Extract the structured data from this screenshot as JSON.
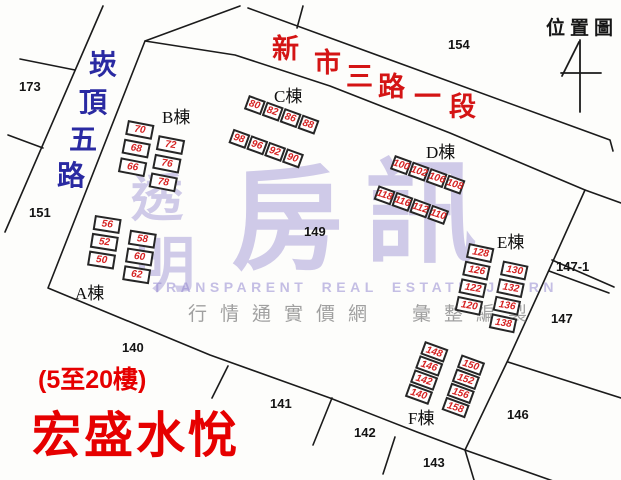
{
  "legend": {
    "title": "位置圖"
  },
  "project": {
    "floors_note": "(5至20樓)",
    "name": "宏盛水悅"
  },
  "watermark": {
    "small_chars": [
      {
        "ch": "透",
        "x": 131,
        "y": 173,
        "size": 52
      },
      {
        "ch": "明",
        "x": 135,
        "y": 236,
        "size": 60
      }
    ],
    "large_chars": [
      {
        "ch": "房",
        "x": 231,
        "y": 165,
        "size": 112
      },
      {
        "ch": "訊",
        "x": 365,
        "y": 158,
        "size": 112
      }
    ],
    "english": "TRANSPARENT REAL ESTATE JOURN",
    "attribution": "行情通實價網　彙整編製"
  },
  "streets": [
    {
      "name": "崁頂五路",
      "color": "#2a2aa2",
      "size": 28,
      "chars": [
        {
          "ch": "崁",
          "x": 89,
          "y": 51
        },
        {
          "ch": "頂",
          "x": 79,
          "y": 89
        },
        {
          "ch": "五",
          "x": 69,
          "y": 126
        },
        {
          "ch": "路",
          "x": 57,
          "y": 162
        }
      ]
    },
    {
      "name": "新市三路一段",
      "color": "#d41414",
      "size": 27,
      "chars": [
        {
          "ch": "新",
          "x": 272,
          "y": 36
        },
        {
          "ch": "市",
          "x": 314,
          "y": 50
        },
        {
          "ch": "三",
          "x": 346,
          "y": 64
        },
        {
          "ch": "路",
          "x": 378,
          "y": 74
        },
        {
          "ch": "一",
          "x": 414,
          "y": 84
        },
        {
          "ch": "段",
          "x": 449,
          "y": 94
        }
      ]
    }
  ],
  "lots": [
    {
      "label": "173",
      "x": 19,
      "y": 79
    },
    {
      "label": "151",
      "x": 29,
      "y": 205
    },
    {
      "label": "154",
      "x": 448,
      "y": 37
    },
    {
      "label": "149",
      "x": 304,
      "y": 224
    },
    {
      "label": "147-1",
      "x": 556,
      "y": 259
    },
    {
      "label": "147",
      "x": 551,
      "y": 311
    },
    {
      "label": "146",
      "x": 507,
      "y": 407
    },
    {
      "label": "140",
      "x": 122,
      "y": 340
    },
    {
      "label": "141",
      "x": 270,
      "y": 396
    },
    {
      "label": "142",
      "x": 354,
      "y": 425
    },
    {
      "label": "143",
      "x": 423,
      "y": 455
    }
  ],
  "buildings": [
    {
      "id": "A",
      "name": "A棟",
      "label": {
        "x": 75,
        "y": 279
      },
      "origin": {
        "x": 95,
        "y": 215
      },
      "rotation": 9,
      "orientation": "v",
      "cell": {
        "w": 27,
        "h": 15,
        "gap": 3
      },
      "groups": [
        {
          "dx": 0,
          "dy": 0,
          "units": [
            "56",
            "52",
            "50"
          ]
        },
        {
          "dx": 37,
          "dy": 9,
          "units": [
            "58",
            "60",
            "62"
          ]
        }
      ]
    },
    {
      "id": "B",
      "name": "B棟",
      "label": {
        "x": 162,
        "y": 103
      },
      "origin": {
        "x": 128,
        "y": 120
      },
      "rotation": 11,
      "orientation": "v",
      "cell": {
        "w": 27,
        "h": 15,
        "gap": 4
      },
      "groups": [
        {
          "dx": 0,
          "dy": 0,
          "units": [
            "70",
            "68",
            "66"
          ]
        },
        {
          "dx": 33,
          "dy": 9,
          "units": [
            "72",
            "76",
            "78"
          ]
        }
      ]
    },
    {
      "id": "C",
      "name": "C棟",
      "label": {
        "x": 274,
        "y": 82
      },
      "origin": {
        "x": 249,
        "y": 95
      },
      "rotation": 20,
      "orientation": "h",
      "cell": {
        "w": 18,
        "h": 15,
        "gap": 1
      },
      "groups": [
        {
          "dx": 0,
          "dy": 0,
          "units": [
            "80",
            "82",
            "86",
            "88"
          ]
        },
        {
          "dx": -3,
          "dy": 37,
          "units": [
            "98",
            "96",
            "92",
            "90"
          ]
        }
      ]
    },
    {
      "id": "D",
      "name": "D棟",
      "label": {
        "x": 426,
        "y": 138
      },
      "origin": {
        "x": 395,
        "y": 155
      },
      "rotation": 20,
      "orientation": "h",
      "cell": {
        "w": 18,
        "h": 15,
        "gap": 1
      },
      "groups": [
        {
          "dx": 0,
          "dy": 0,
          "units": [
            "100",
            "102",
            "106",
            "108"
          ]
        },
        {
          "dx": -5,
          "dy": 34,
          "units": [
            "118",
            "116",
            "112",
            "110"
          ]
        }
      ]
    },
    {
      "id": "E",
      "name": "E棟",
      "label": {
        "x": 497,
        "y": 228
      },
      "origin": {
        "x": 469,
        "y": 243
      },
      "rotation": 12,
      "orientation": "v",
      "cell": {
        "w": 26,
        "h": 15,
        "gap": 3
      },
      "groups": [
        {
          "dx": 0,
          "dy": 0,
          "units": [
            "128",
            "126",
            "122",
            "120"
          ]
        },
        {
          "dx": 37,
          "dy": 10,
          "units": [
            "130",
            "132",
            "136",
            "138"
          ]
        }
      ]
    },
    {
      "id": "F",
      "name": "F棟",
      "label": {
        "x": 408,
        "y": 404
      },
      "origin": {
        "x": 425,
        "y": 341
      },
      "rotation": 20,
      "orientation": "v",
      "cell": {
        "w": 25,
        "h": 14,
        "gap": 1
      },
      "groups": [
        {
          "dx": 0,
          "dy": 0,
          "units": [
            "148",
            "146",
            "142",
            "140"
          ]
        },
        {
          "dx": 39,
          "dy": 0,
          "units": [
            "150",
            "152",
            "156",
            "158"
          ]
        }
      ]
    }
  ]
}
